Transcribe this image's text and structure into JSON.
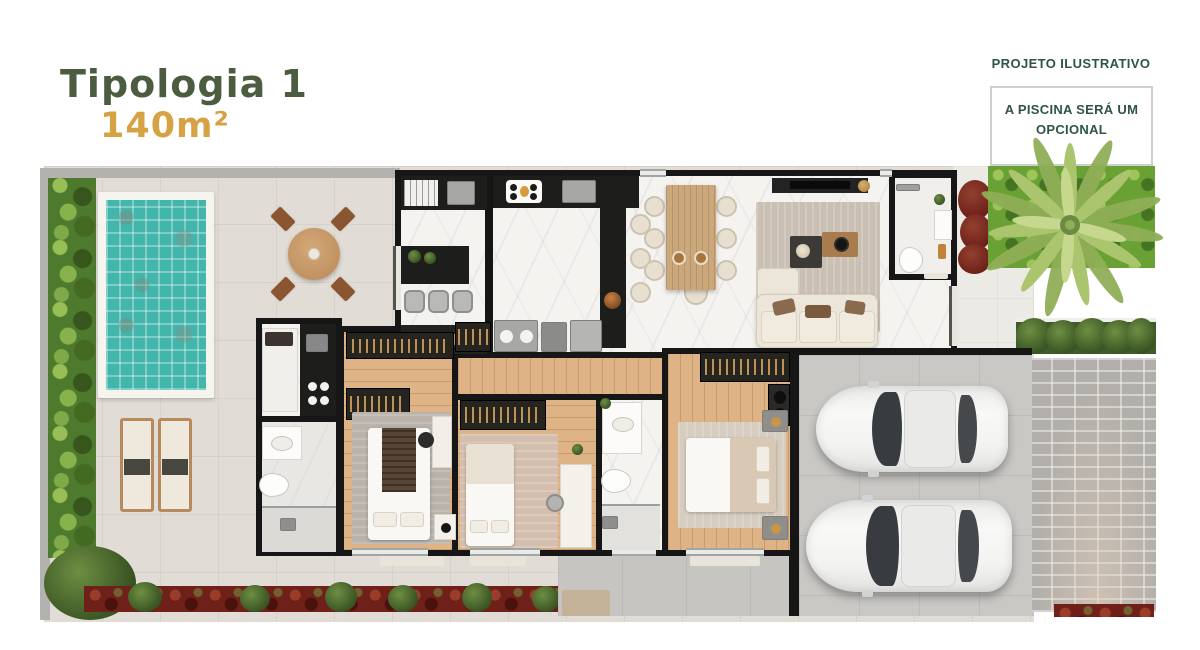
{
  "header": {
    "typology": "Tipologia 1",
    "area": "140m²"
  },
  "notes": {
    "top_right": "PROJETO ILUSTRATIVO",
    "pool_optional": "A PISCINA SERÁ UM OPCIONAL"
  },
  "palette": {
    "title_green": "#4C5C41",
    "area_gold": "#D7A244",
    "note_green": "#2F5447",
    "wall_black": "#161616",
    "pool_water": "#43B6AB",
    "hedge_green": "#4E7A2E",
    "grass_green": "#69A135",
    "patio_cream": "#E1DDD6",
    "marble_white": "#F5F3F0",
    "wood_floor": "#DEB487",
    "garage_gray": "#C9C8C5",
    "driveway_gray": "#B2AFAA",
    "flowerbed_red": "#6E2019",
    "car_white": "#F3F3F2"
  },
  "plan": {
    "outdoor_elements": [
      "perimeter-hedge",
      "swimming-pool",
      "sun-loungers",
      "outdoor-dining-set",
      "flower-bed",
      "lawn",
      "palm-tree",
      "planter-hedge",
      "paver-driveway",
      "walkway"
    ],
    "rooms": [
      "gourmet-kitchen",
      "kitchen",
      "laundry-nook",
      "dining-room",
      "living-room",
      "social-bathroom",
      "utility-room",
      "bathroom-1",
      "bedroom-1",
      "hallway",
      "bedroom-2",
      "bathroom-2",
      "master-suite",
      "garage"
    ],
    "vehicle_count": 2
  }
}
